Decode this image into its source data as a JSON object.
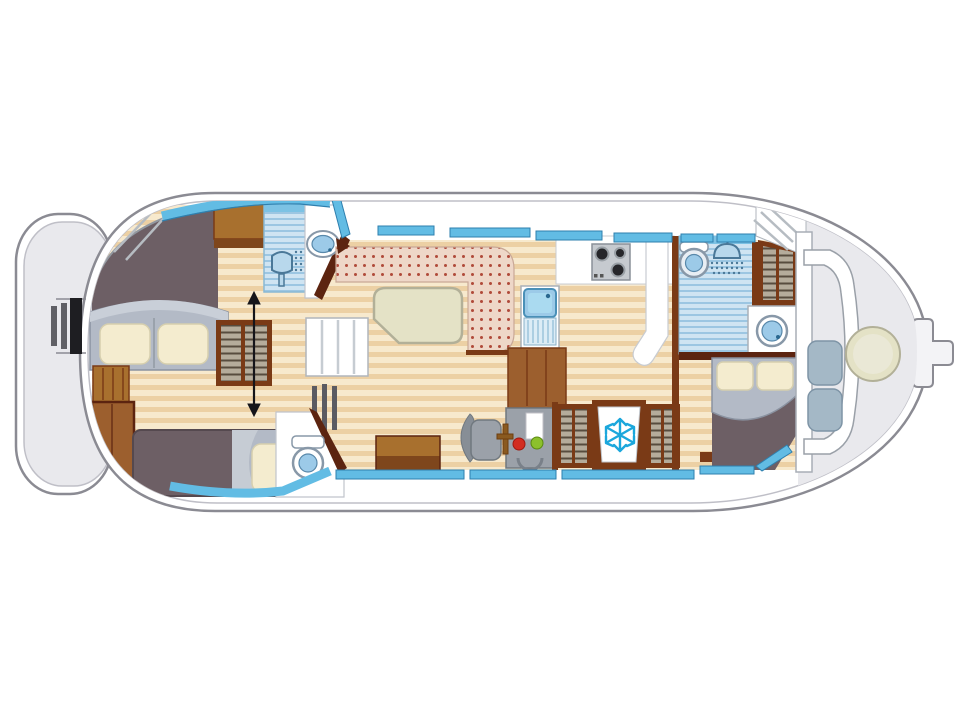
{
  "meta": {
    "type": "boat-deck-floorplan",
    "description": "Top-down interior deck plan of a canal houseboat, bow at left, tiller at stern right, no text labels rendered in the drawing"
  },
  "colors": {
    "white": "#ffffff",
    "deck": "#e9e9ed",
    "hull_stroke": "#8b8b93",
    "hull_inner": "#bfbfc7",
    "taupe": "#6d5f65",
    "wood_base": "#f7e9cd",
    "wood_stripe": "#ecd0a4",
    "brown": "#a8702e",
    "brown_mid": "#9c5f2e",
    "brown_dark": "#7a3a16",
    "brown_darkest": "#5c2410",
    "sofa_base": "#eed7c8",
    "sofa_dot": "#b04a3a",
    "window": "#62bce4",
    "window_stroke": "#2e7fae",
    "shower_base": "#cfe4f2",
    "shower_stripe": "#9cc6e2",
    "shower_top": "#7cc2e4",
    "bed_gray": "#b3bac6",
    "bed_gray_light": "#c9cfd8",
    "pillow": "#f4eccf",
    "pillow_stroke": "#d6cfae",
    "table": "#e4e2c6",
    "table_stroke": "#b2b098",
    "console": "#9ba1a9",
    "console_stroke": "#70787f",
    "cushion": "#a4b8c6",
    "cushion_stroke": "#7e94a6",
    "fixture": "#9ccae8",
    "fixture_deep": "#5888aa",
    "snowflake": "#1ba7dc",
    "stove": "#26262a",
    "red_light": "#d22c20",
    "green_light": "#8cc02c",
    "shelf_base": "#b5ac9b",
    "shelf_line": "#574c3e",
    "arrow": "#15151a",
    "sheet": "#c6ccd4",
    "drain": "#dcecf6"
  },
  "vessel": {
    "orientation": {
      "bow": "left",
      "stern": "right"
    },
    "sections": [
      {
        "name": "bow-deck",
        "features": [
          "boarding-slats",
          "foredeck-steps"
        ]
      },
      {
        "name": "forward-cabin",
        "features": [
          "v-double-berth",
          "two-pillows",
          "single-berth",
          "wardrobe-with-slide-arrow",
          "storage-cabinets"
        ]
      },
      {
        "name": "forward-bathroom",
        "features": [
          "shower",
          "corner-washbasin",
          "toilet",
          "radiator"
        ]
      },
      {
        "name": "saloon",
        "features": [
          "l-shaped-dinette-sofa",
          "dining-table",
          "companionway-steps"
        ]
      },
      {
        "name": "galley",
        "features": [
          "three-burner-stove",
          "sink-with-drainboard",
          "counter",
          "storage-block"
        ]
      },
      {
        "name": "helm",
        "features": [
          "console-with-indicators",
          "steering-wheel",
          "helm-seat",
          "step-box"
        ]
      },
      {
        "name": "storage-row",
        "features": [
          "shelf-cabinet-left",
          "refrigerator",
          "shelf-cabinet-right"
        ]
      },
      {
        "name": "aft-bathroom",
        "features": [
          "shower",
          "toilet",
          "washbasin",
          "wardrobe"
        ]
      },
      {
        "name": "aft-cabin",
        "features": [
          "double-berth",
          "two-pillows"
        ]
      },
      {
        "name": "aft-deck",
        "features": [
          "curved-bench",
          "two-cushions",
          "round-table",
          "companionway-steps",
          "tiller"
        ]
      }
    ]
  },
  "icons": [
    "shower-head-icon",
    "snowflake-icon",
    "stove-burners-icon",
    "double-arrow-icon",
    "toilet-icon",
    "washbasin-icon",
    "steering-wheel-icon",
    "nav-indicator-lights-icon"
  ]
}
